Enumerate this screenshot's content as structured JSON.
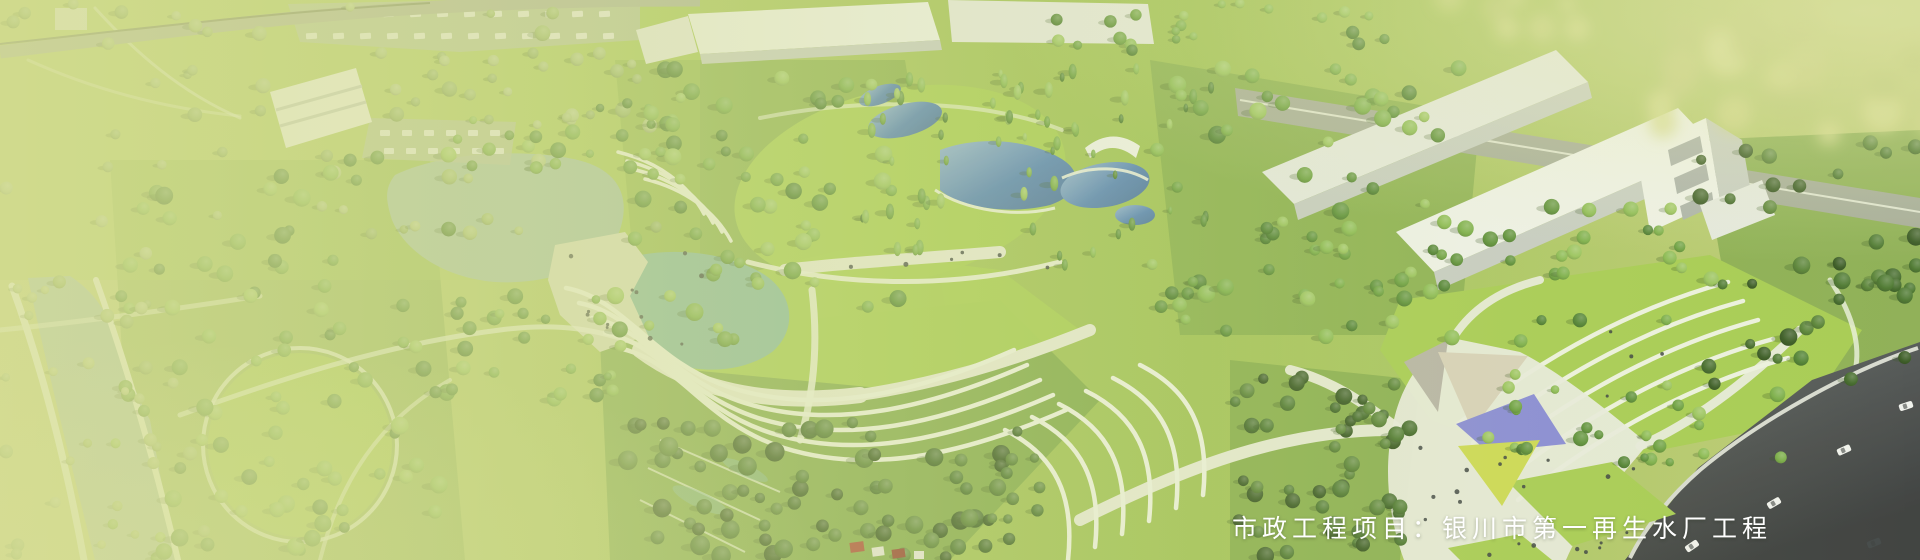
{
  "banner": {
    "caption": "市政工程项目：银川市第一再生水厂工程",
    "caption_color": "#ffffff"
  },
  "palette": {
    "bg_left": "#c3d07c",
    "bg_mid": "#a6c35a",
    "bg_mid2": "#9cbf50",
    "bg_right": "#bfcc78",
    "haze": "#d8de96",
    "haze_bright": "#e9eab2",
    "lawn": "#a5cb4f",
    "lawn_deep": "#8fbf3f",
    "forest_floor": "#79a346",
    "water_lake": "#a3bfa2",
    "water_pond": "#84b79c",
    "water_canal": "#a9bfa9",
    "pool_deep": "#4c7db8",
    "pool_light": "#8fb2d8",
    "path": "#eef2e2",
    "path_wide": "#e6ead6",
    "plaza_tan": "#d9dcbc",
    "plaza_white": "#e9ebdf",
    "building": "#f0f2ed",
    "building_shade": "#e6e9e3",
    "building_side": "#c6cbc5",
    "building_dark": "#a8aeab",
    "road_top": "#a9b095",
    "road_edge": "#79825f",
    "road_gray": "#a3a998",
    "road_dark1": "#5c6062",
    "road_dark2": "#36383a",
    "sidewalk": "#d8dad2",
    "parking": "#b4bfa0",
    "car_light": "#f2f3f0",
    "car_dark": "#3c4043",
    "canopy_gray": "#b5b1a6",
    "canopy_tan": "#d8d0ba",
    "canopy_purple": "#8486d8",
    "canopy_yellow": "#ccd94f",
    "people": "#33383b",
    "tree_shadow": "#2f4f1c",
    "red_roof": "#a8402f",
    "red_roof_dark": "#8e3326",
    "roof_white": "#e8e6e0"
  },
  "tree_palettes": {
    "greens": [
      "#4a7d2e",
      "#578c34",
      "#669c3b",
      "#76ab44",
      "#87b84e",
      "#97c25a"
    ],
    "dark": [
      "#33551f",
      "#3d6526",
      "#48742d",
      "#547f33"
    ],
    "hazy": [
      "#9ab768",
      "#a6bf74",
      "#8fae5e",
      "#b1c681"
    ],
    "bokeh": [
      "#c2cc7a",
      "#cdd584",
      "#b8c671",
      "#d6db90"
    ]
  }
}
